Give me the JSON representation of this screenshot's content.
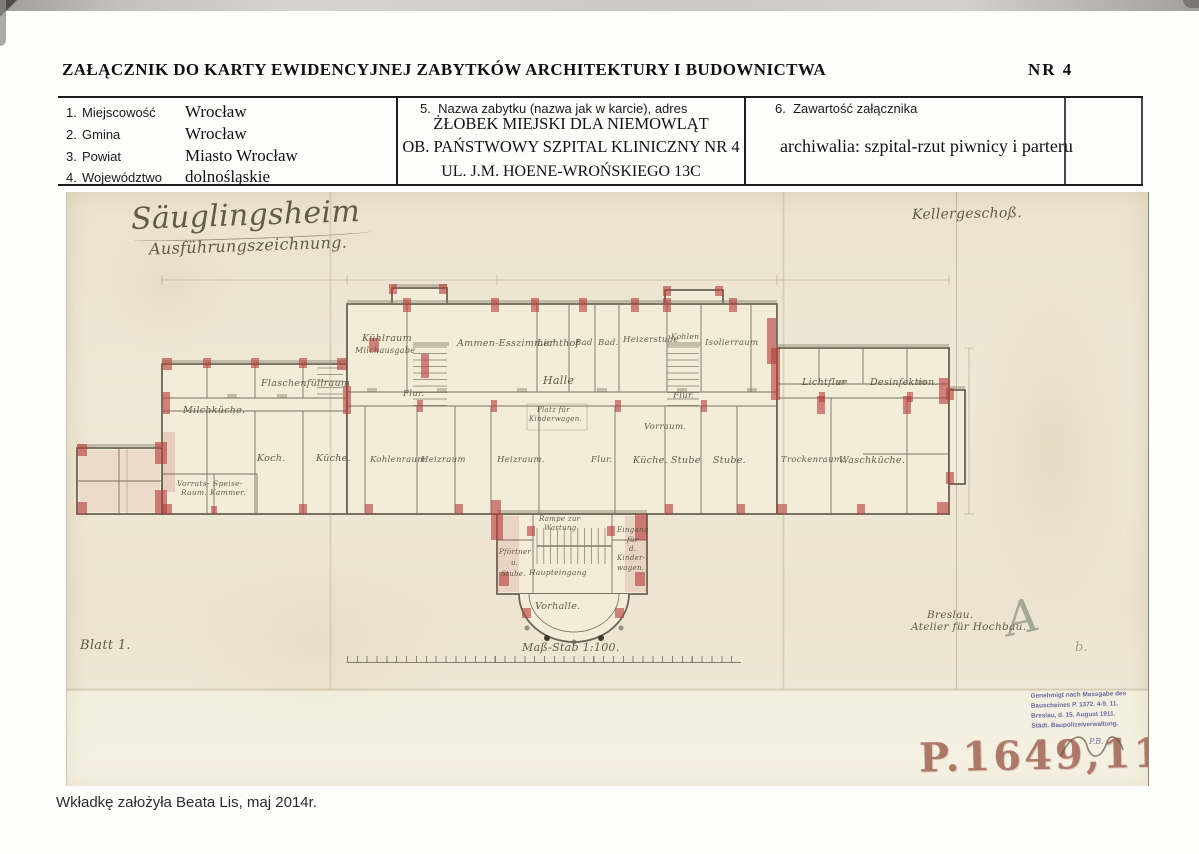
{
  "header": {
    "title": "ZAŁĄCZNIK DO KARTY EWIDENCYJNEJ ZABYTKÓW  ARCHITEKTURY I BUDOWNICTWA",
    "number": "NR  4"
  },
  "form": {
    "fields": [
      {
        "no": "1.",
        "label": "Miejscowość",
        "value": "Wrocław"
      },
      {
        "no": "2.",
        "label": "Gmina",
        "value": "Wrocław"
      },
      {
        "no": "3.",
        "label": "Powiat",
        "value": "Miasto Wrocław"
      },
      {
        "no": "4.",
        "label": "Województwo",
        "value": "dolnośląskie"
      }
    ],
    "monument": {
      "no": "5.",
      "label": "Nazwa zabytku  (nazwa jak w karcie), adres",
      "lines": [
        "ŻŁOBEK MIEJSKI DLA NIEMOWLĄT",
        "OB. PAŃSTWOWY SZPITAL KLINICZNY NR 4",
        "UL. J.M. HOENE-WROŃSKIEGO 13C"
      ]
    },
    "contents": {
      "no": "6.",
      "label": "Zawartość załącznika",
      "value": "archiwalia: szpital-rzut piwnicy i parteru"
    }
  },
  "drawing": {
    "title": "Säuglingsheim",
    "subtitle": "Ausführungszeichnung.",
    "floor": "Kellergeschoß.",
    "sheet": "Blatt 1.",
    "scale": "Maß-Stab 1:100.",
    "atelier_line1": "Breslau.",
    "atelier_line2": "Atelier für Hochbau.",
    "room_labels": [
      {
        "t": "Kühlraum",
        "x": 295,
        "y": 141
      },
      {
        "t": "Milchausgabe",
        "x": 288,
        "y": 154,
        "s": 8
      },
      {
        "t": "Ammen-Esszimmer",
        "x": 390,
        "y": 146
      },
      {
        "t": "Lichthof",
        "x": 470,
        "y": 146
      },
      {
        "t": "Bad",
        "x": 508,
        "y": 146,
        "s": 8.5
      },
      {
        "t": "Bad.",
        "x": 531,
        "y": 146,
        "s": 8.5
      },
      {
        "t": "Heizerstube",
        "x": 556,
        "y": 143,
        "s": 8.5
      },
      {
        "t": "Kohlen",
        "x": 604,
        "y": 140,
        "s": 7.5
      },
      {
        "t": "Isolierraum",
        "x": 638,
        "y": 146,
        "s": 8.5
      },
      {
        "t": "Lichtflur",
        "x": 735,
        "y": 185
      },
      {
        "t": "Desinfektion.",
        "x": 803,
        "y": 185
      },
      {
        "t": "Flaschenfüllraum",
        "x": 194,
        "y": 186
      },
      {
        "t": "Flur.",
        "x": 336,
        "y": 197,
        "s": 8.5
      },
      {
        "t": "Halle",
        "x": 476,
        "y": 182,
        "s": 11
      },
      {
        "t": "Flur.",
        "x": 606,
        "y": 199,
        "s": 8.5
      },
      {
        "t": "Milchküche.",
        "x": 116,
        "y": 213
      },
      {
        "t": "Platz für",
        "x": 470,
        "y": 214,
        "s": 7
      },
      {
        "t": "Kinderwagen.",
        "x": 462,
        "y": 223,
        "s": 7
      },
      {
        "t": "Vorraum.",
        "x": 577,
        "y": 230,
        "s": 8.5
      },
      {
        "t": "Koch.",
        "x": 190,
        "y": 261
      },
      {
        "t": "Küche.",
        "x": 249,
        "y": 261
      },
      {
        "t": "Kohlenraum",
        "x": 303,
        "y": 263,
        "s": 8.5
      },
      {
        "t": "Heizraum",
        "x": 354,
        "y": 263,
        "s": 8.5
      },
      {
        "t": "Heizraum.",
        "x": 430,
        "y": 263,
        "s": 8.5
      },
      {
        "t": "Flur.",
        "x": 524,
        "y": 263,
        "s": 8.5
      },
      {
        "t": "Küche.",
        "x": 566,
        "y": 263
      },
      {
        "t": "Stube",
        "x": 604,
        "y": 263
      },
      {
        "t": "Stube.",
        "x": 646,
        "y": 263
      },
      {
        "t": "Trockenraum.",
        "x": 714,
        "y": 263,
        "s": 8.5
      },
      {
        "t": "Waschküche.",
        "x": 772,
        "y": 263
      },
      {
        "t": "Vorrats-",
        "x": 110,
        "y": 287,
        "s": 7.5
      },
      {
        "t": "Raum.",
        "x": 114,
        "y": 296,
        "s": 7.5
      },
      {
        "t": "Speise-",
        "x": 146,
        "y": 287,
        "s": 7.5
      },
      {
        "t": "Kammer.",
        "x": 143,
        "y": 296,
        "s": 7.5
      },
      {
        "t": "Rampe zur",
        "x": 472,
        "y": 323,
        "s": 7
      },
      {
        "t": "Wartung",
        "x": 477,
        "y": 332,
        "s": 7
      },
      {
        "t": "Eingang",
        "x": 550,
        "y": 334,
        "s": 7
      },
      {
        "t": "für",
        "x": 560,
        "y": 344,
        "s": 7
      },
      {
        "t": "d.",
        "x": 562,
        "y": 353,
        "s": 7
      },
      {
        "t": "Kinder-",
        "x": 550,
        "y": 362,
        "s": 7
      },
      {
        "t": "wagen.",
        "x": 550,
        "y": 372,
        "s": 7
      },
      {
        "t": "Pförtner",
        "x": 432,
        "y": 356,
        "s": 7
      },
      {
        "t": "u.",
        "x": 444,
        "y": 367,
        "s": 7
      },
      {
        "t": "Stube.",
        "x": 434,
        "y": 378,
        "s": 7
      },
      {
        "t": "Haupteingang",
        "x": 462,
        "y": 376,
        "s": 7.5
      },
      {
        "t": "Vorhalle.",
        "x": 468,
        "y": 409
      }
    ]
  },
  "stamps": {
    "approval_lines": [
      "Genehmigt nach Massgabe des",
      "Bauscheines P. 1372. 4-9. 11.",
      "Breslau, d. 15. August 1911.",
      "Städt. Baupolizeiverwaltung."
    ],
    "initials": "P.B.",
    "inventory_number": "P.1649,11",
    "monogram": "A",
    "note": "b."
  },
  "footer": {
    "note": "Wkładkę założyła Beata Lis, maj  2014r."
  },
  "colors": {
    "wall_red": "#b5413c",
    "paper_cream": "#efe8d6",
    "ink_brown": "#564f3d",
    "stamp_purple": "#5a5e9d",
    "stamp_red": "#9f6352"
  }
}
